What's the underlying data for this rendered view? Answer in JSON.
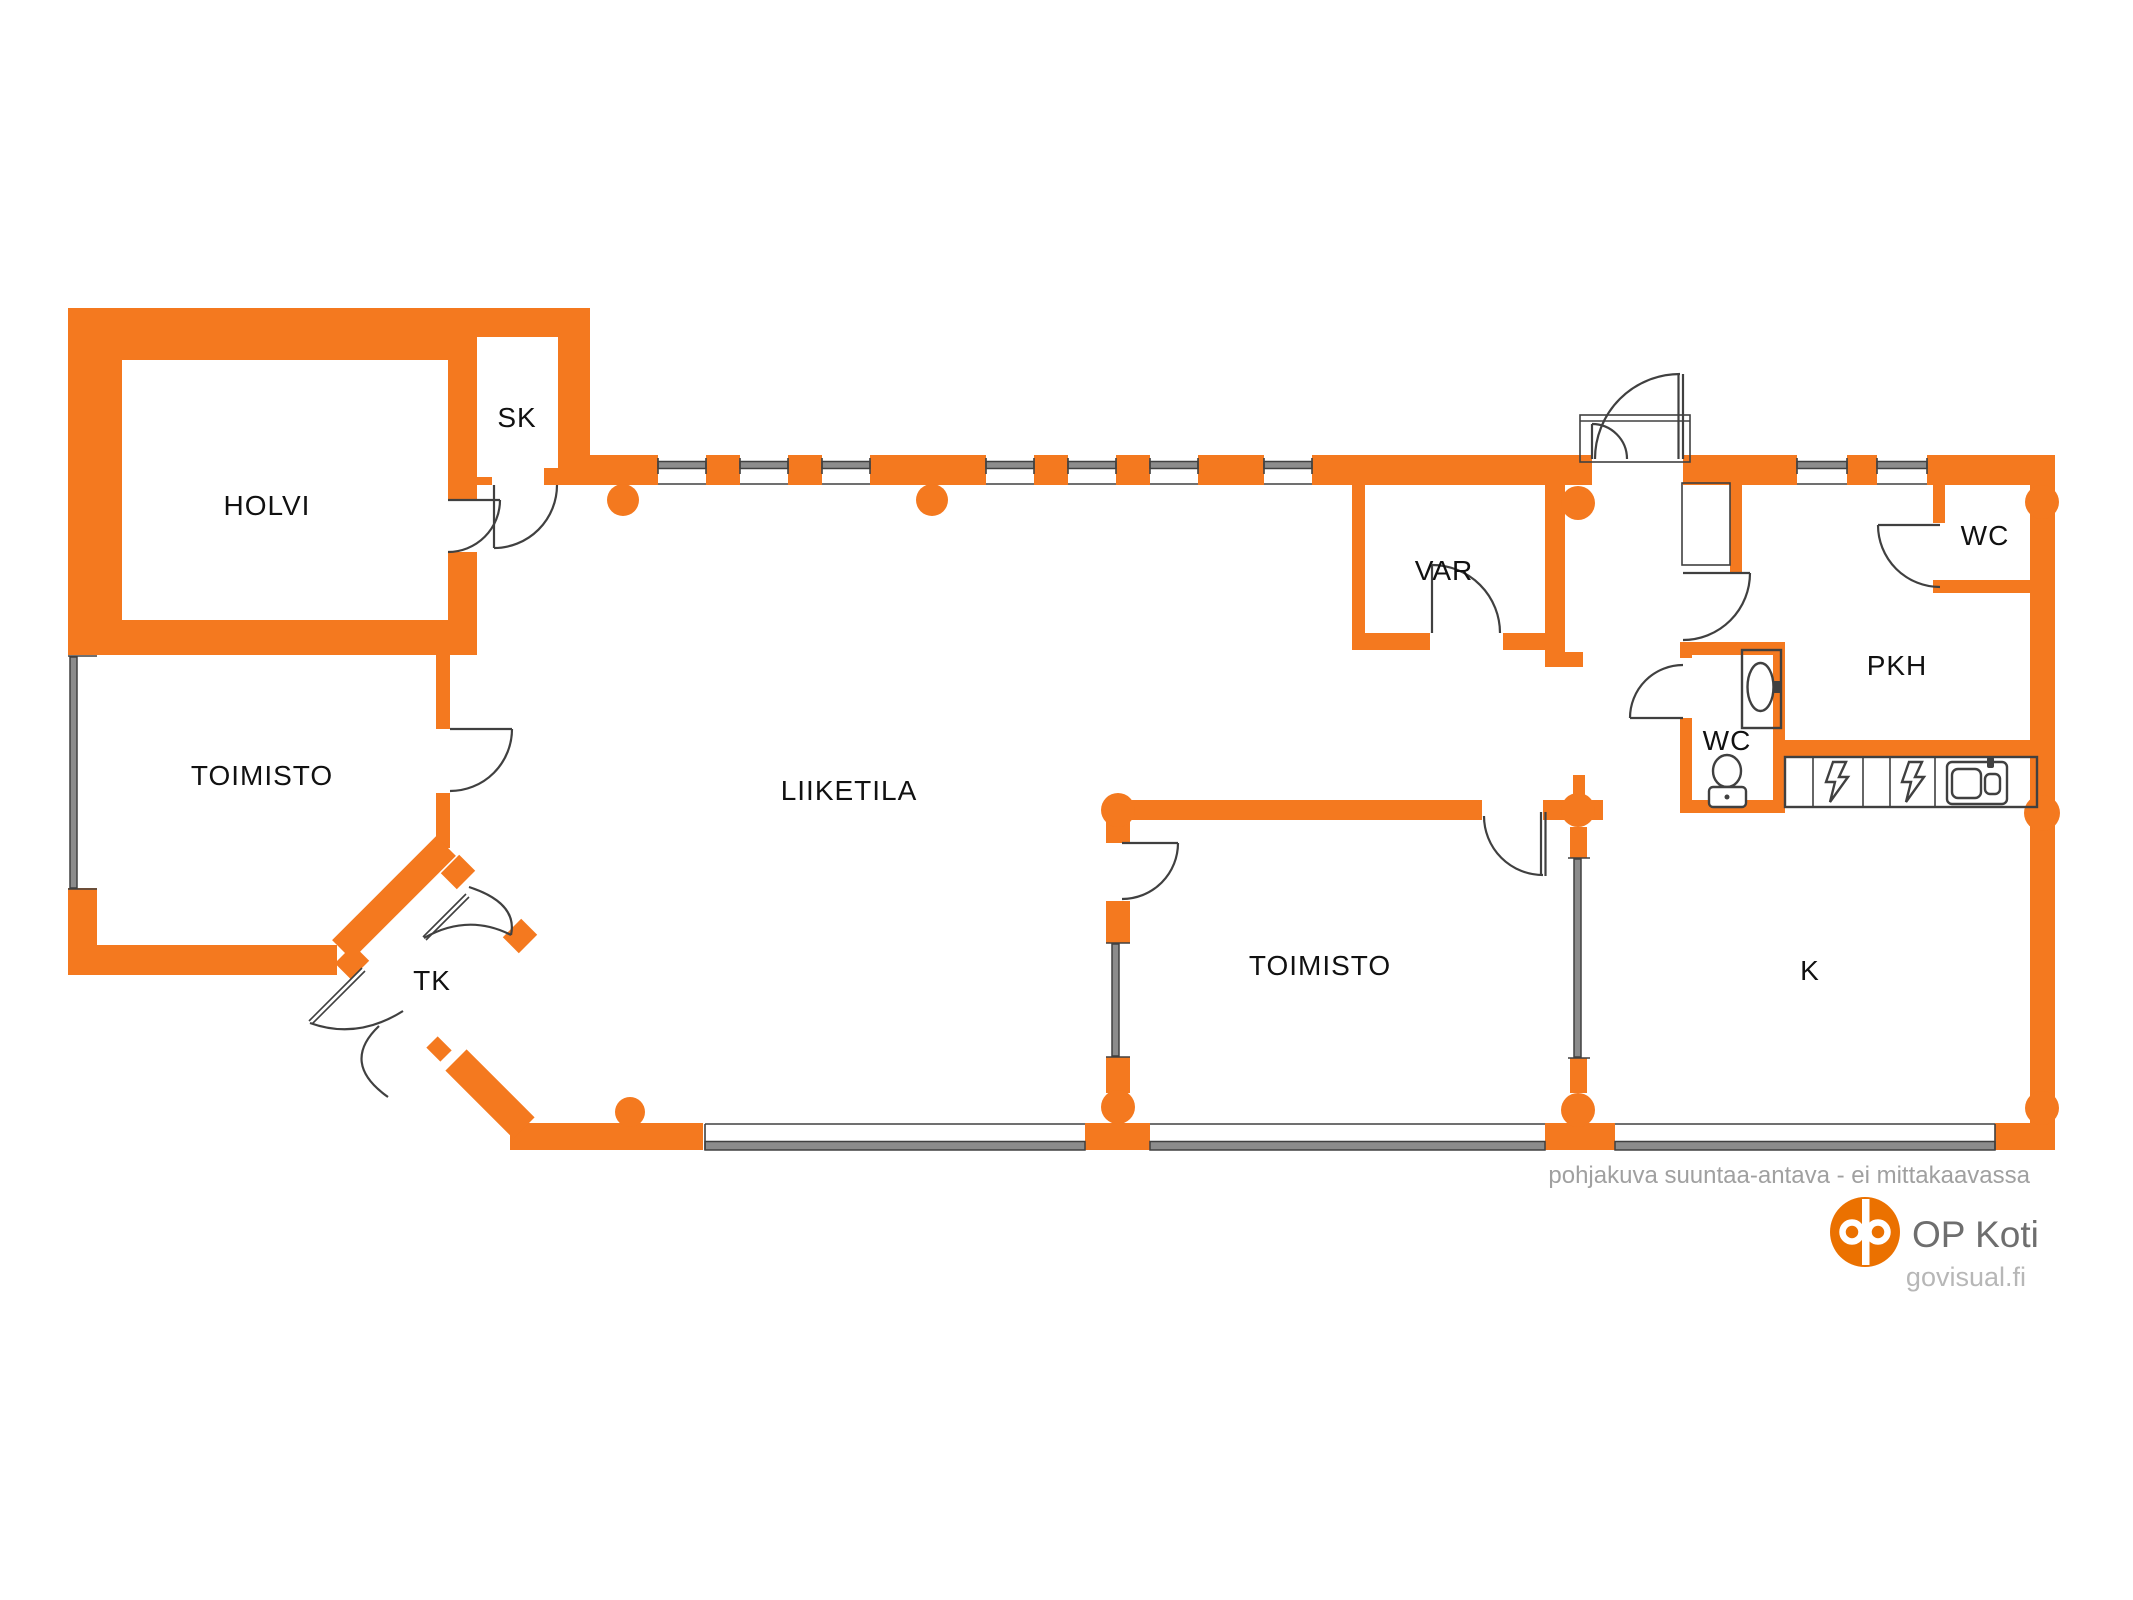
{
  "plan": {
    "type": "floor-plan",
    "rooms": {
      "holvi": {
        "label": "HOLVI"
      },
      "sk": {
        "label": "SK"
      },
      "toimisto_left": {
        "label": "TOIMISTO"
      },
      "liiketila": {
        "label": "LIIKETILA"
      },
      "var": {
        "label": "VAR"
      },
      "wc_top_right": {
        "label": "WC"
      },
      "pkh": {
        "label": "PKH"
      },
      "wc_small": {
        "label": "WC"
      },
      "toimisto_bottom": {
        "label": "TOIMISTO"
      },
      "kitchen": {
        "label": "K"
      },
      "tk": {
        "label": "TK"
      }
    }
  },
  "footer": {
    "disclaimer": "pohjakuva suuntaa-antava - ei mittakaavassa",
    "brand": "OP Koti",
    "website": "govisual.fi"
  },
  "colors": {
    "wall": "#F4791F",
    "logo": "#EB7100",
    "line": "#404040",
    "glazing": "#8C8C8C",
    "disclaimer_text": "#A0A0A0",
    "brand_text": "#6E6E6E",
    "website_text": "#B7B7B7"
  }
}
